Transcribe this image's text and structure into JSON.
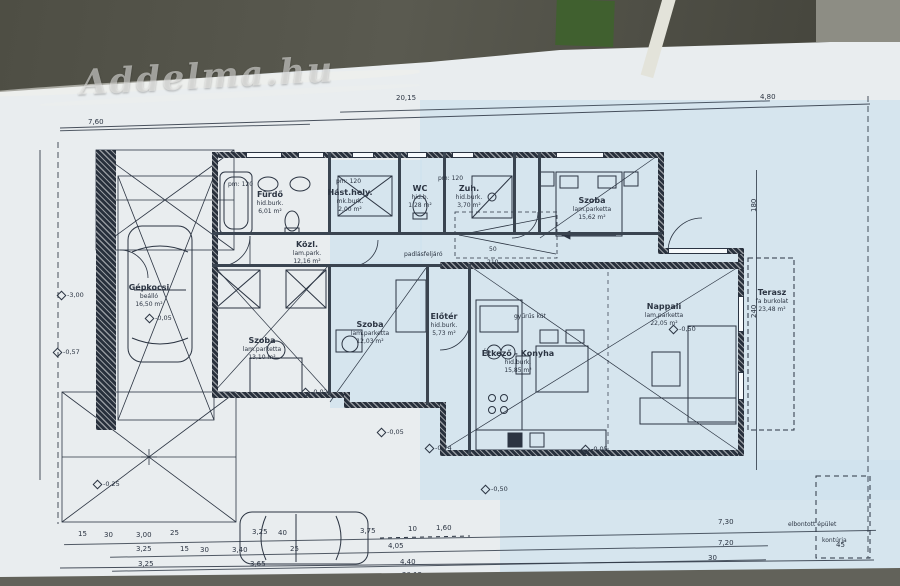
{
  "watermark": "Addelma.hu",
  "colors": {
    "paper": "#e9edef",
    "tint": "#cfe2ee",
    "ink": "#2b3442",
    "photo_bg": "#56564b",
    "green_block": "#40602f"
  },
  "rooms": {
    "furdo": {
      "name": "Fürdő",
      "floor": "hid.burk.",
      "area": "6,01 m²"
    },
    "hast": {
      "name": "Hást.hely.",
      "floor": "mk.burk.",
      "area": "2,00 m²"
    },
    "wc": {
      "name": "WC",
      "floor": "hid.b.",
      "area": "1,28 m²"
    },
    "zuh": {
      "name": "Zuh.",
      "floor": "hid.burk.",
      "area": "3,70 m²"
    },
    "szoba_eny": {
      "name": "Szoba",
      "floor": "lam.parketta",
      "area": "15,62 m²"
    },
    "kozl": {
      "name": "Közl.",
      "floor": "lam.park.",
      "area": "12,16 m²"
    },
    "szoba_bal": {
      "name": "Szoba",
      "floor": "lam.parketta",
      "area": "13,10 m²"
    },
    "szoba_kozep": {
      "name": "Szoba",
      "floor": "lam.parketta",
      "area": "12,03 m²"
    },
    "eloter": {
      "name": "Előtér",
      "floor": "hid.burk.",
      "area": "5,73 m²"
    },
    "konyha": {
      "name": "Étkező - Konyha",
      "floor": "hid.burk.",
      "area": "15,85 m²"
    },
    "nappali": {
      "name": "Nappali",
      "floor": "lam.parketta",
      "area": "22,05 m²"
    },
    "terasz": {
      "name": "Terasz",
      "floor": "fa burkolat",
      "area": "23,48 m²"
    },
    "beallo": {
      "name": "Gépkocsi",
      "floor": "beálló",
      "area": "16,50 m²"
    }
  },
  "annotations": {
    "pm1": "pm: 120",
    "pm2": "pm: 120",
    "pm3": "pm: 120",
    "attic": "padlásfeljáró",
    "well": "gyűrűs kút",
    "door_w": "50",
    "door_h": "210",
    "demolished_line1": "elbontott épület",
    "demolished_line2": "kontúrja"
  },
  "elevations": [
    "-3,00",
    "-0,57",
    "-0,05",
    "-0,02",
    "-0,05",
    "-0,74",
    "-0,50",
    "-0,05",
    "-0,50",
    "-0,25"
  ],
  "dims": {
    "top": [
      "7,60",
      "20,15",
      "4,80"
    ],
    "bottom_row1": [
      "15",
      "30",
      "3,00",
      "25",
      "3,25",
      "40",
      "3,75",
      "10",
      "1,60",
      "7,30"
    ],
    "bottom_row2": [
      "3,25",
      "15",
      "30",
      "3,40",
      "25",
      "4,05",
      "7,20"
    ],
    "bottom_row3": [
      "3,25",
      "3,65",
      "4,40",
      "30"
    ],
    "total": "20,15",
    "right_col": [
      "240",
      "180",
      "45"
    ]
  }
}
